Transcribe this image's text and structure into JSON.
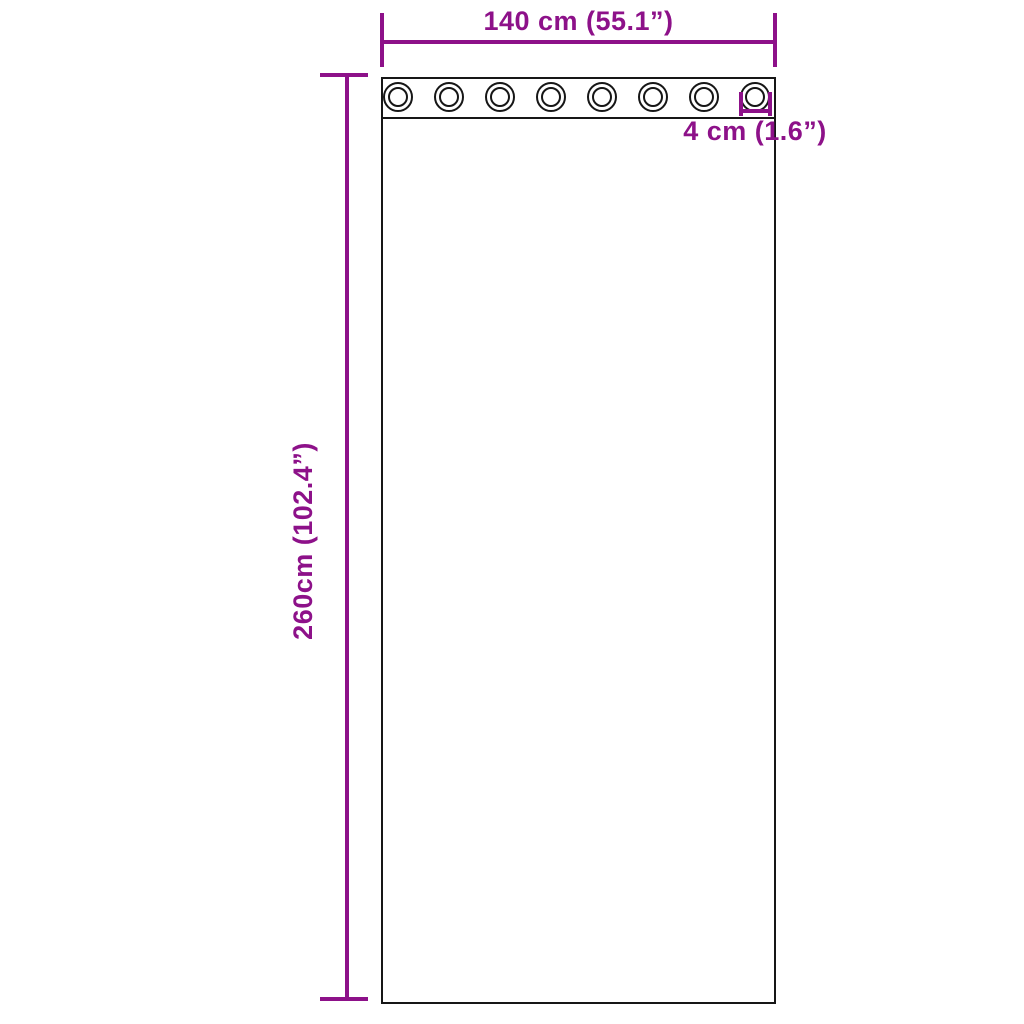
{
  "diagram": {
    "kind": "product-dimension-diagram",
    "width_dimension": {
      "label": "140 cm (55.1”)",
      "value_cm": 140,
      "value_in": 55.1
    },
    "height_dimension": {
      "label": "260cm (102.4”)",
      "value_cm": 260,
      "value_in": 102.4
    },
    "grommet_dimension": {
      "label": "4 cm (1.6”)",
      "value_cm": 4,
      "value_in": 1.6
    },
    "grommet_count": 8,
    "colors": {
      "dimension_accent": "#8d1189",
      "outline": "#161616",
      "background": "#ffffff"
    }
  }
}
